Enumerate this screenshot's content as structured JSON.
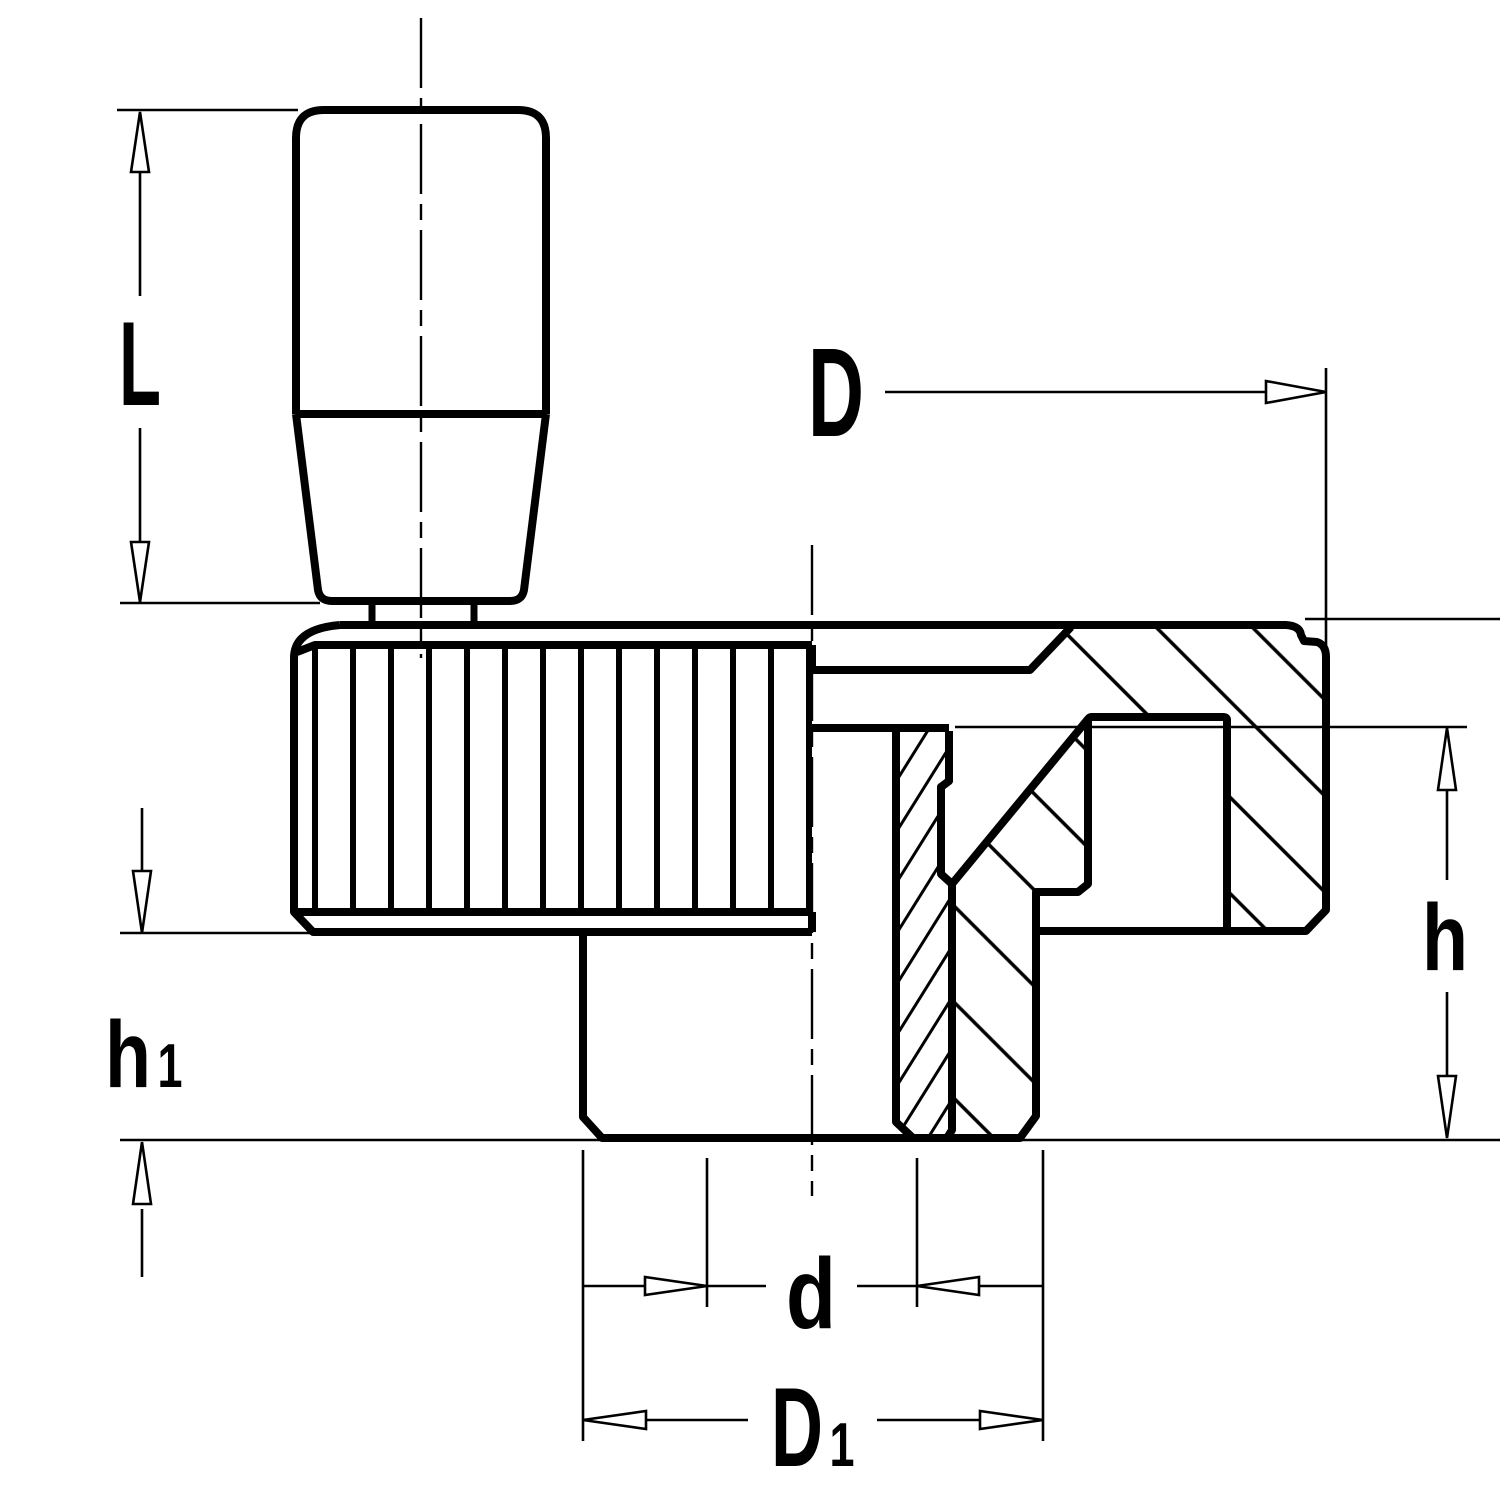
{
  "page": {
    "background": "#ffffff",
    "line_color": "#000000"
  },
  "drawing": {
    "kind": "technical sectional drawing of a knurled disk handwheel with cylindrical revolving handle",
    "dimension_labels": {
      "L": "L",
      "D": "D",
      "h": "h",
      "h1_main": "h",
      "h1_sub": "1",
      "d": "d",
      "D1_main": "D",
      "D1_sub": "1"
    }
  }
}
